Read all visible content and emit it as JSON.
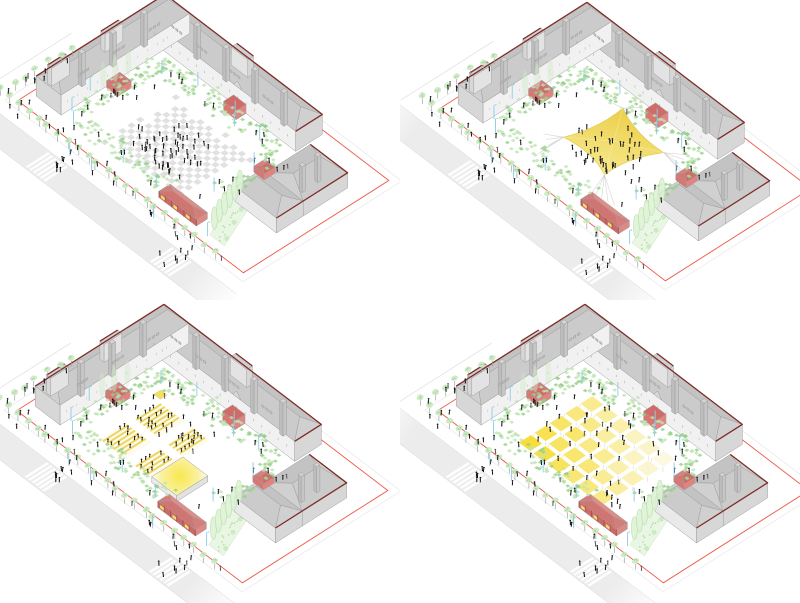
{
  "page": {
    "title": "Courtyard public-space scenarios - axonometric diagram set",
    "background": "#ffffff"
  },
  "panels": [
    {
      "id": "plaza-everyday",
      "name": "Scenario 1 - open checkered plaza with gathering crowd",
      "feature": "checker"
    },
    {
      "id": "event-canopy",
      "name": "Scenario 2 - central tensile event canopy",
      "feature": "canopy"
    },
    {
      "id": "open-air-stage",
      "name": "Scenario 3 - open-air stage with tiered seating",
      "feature": "stage"
    },
    {
      "id": "market-grid",
      "name": "Scenario 4 - market with grid of stall canopies",
      "feature": "market"
    }
  ],
  "colors": {
    "background": "#ffffff",
    "wall_bright": "#f1f1f1",
    "wall_light": "#e3e3e3",
    "wall_mid": "#d7d7d7",
    "roof_near": "#cbcbcb",
    "roof_far": "#c3c3c3",
    "roof_hip": "#d0d0d0",
    "roof_line": "#9e9e9e",
    "silhouette_red": "#7c2d28",
    "boundary_red": "#ee5847",
    "kiosk_red": "#e2837f",
    "kiosk_roof": "#cf6c68",
    "kiosk_line": "#a84b48",
    "pavilion_red": "#dd8a86",
    "pavilion_roof": "#d07672",
    "tree_fill": "#cfeac6",
    "tree_dot": "#a3d79a",
    "trunk": "#a0a0a0",
    "green_a": "#bfe3b3",
    "green_b": "#95cf88",
    "cypress_fill": "#def2d4",
    "cypress_line": "#b5dfaa",
    "bed_fill": "#e9f6e3",
    "bed_line": "#cfe9c6",
    "pole_blue": "#8ccbe8",
    "people": "#161616",
    "people_alt": "#5a5a5a",
    "road": "#ececec",
    "curb": "#dcdcdc",
    "outer_line": "#e3e3e3",
    "checker": "#e1e1e1",
    "canopy_deep": "#eccf4a",
    "canopy_light": "#f6e98f",
    "canopy_line": "#dfc94e",
    "guy_line": "#c9c9c9",
    "stall_bright": "#f7de3a",
    "stall_pale": "#fcf8e2",
    "seat_stripe": "#ecd55b",
    "seat_base": "#fdfaec",
    "stage_core": "#f8e84e",
    "stage_mid": "#faf0a0",
    "stage_edge": "#fefdf4",
    "stage_side": "#ececec",
    "window_tick": "#8a8a8a",
    "dormer": "#c2c2c2"
  },
  "scene": {
    "people": {
      "sidewalk": 26,
      "nw_sidewalk": 7,
      "ring_top": 8,
      "ring_left": 7,
      "ring_right": 6,
      "ring_bottom": 5,
      "crosswalk_group": 7,
      "east_gate": 4,
      "west_gate": 4,
      "plaza_crowd": 56,
      "canopy_crowd": 46,
      "stage_standing": 14,
      "market_visitors": 40,
      "seat_occupancy": 0.42
    },
    "market": {
      "cols": 6,
      "rows": 5
    },
    "seating": {
      "blocks": 4,
      "row_pitch": 1.7
    },
    "street": {
      "crosswalks": 2,
      "stripes_per_crosswalk": 6
    },
    "trees": {
      "street_sw": 23,
      "street_nw": 6,
      "cypresses": 6,
      "poplars": 3
    },
    "poles": 16
  }
}
